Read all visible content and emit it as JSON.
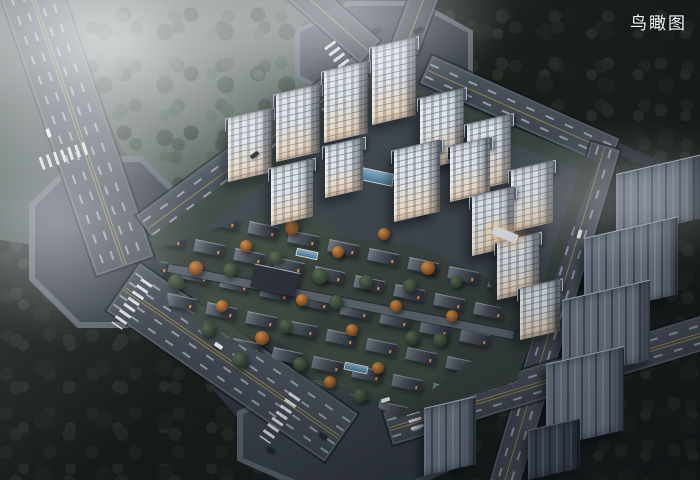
{
  "header": {
    "view_label": "鸟瞰图"
  },
  "palette": {
    "fog": "#e8ecee",
    "asphalt": "#454b55",
    "intersection": "#3a404a",
    "lane_white": "#dfe6ec",
    "lane_yellow": "#9b8c4d",
    "tower_facade": "#dde3e8",
    "tower_roof": "#39414f",
    "window_glow": "#f2a85c",
    "villa_roof": "#4a505a",
    "context_building_light": "#6f7988",
    "context_building_dark": "#434b58",
    "forest_dark": "#262e2a",
    "meadow": "#4a5350",
    "lawn": "#3e4c41",
    "pool_water": "#6e9ab5",
    "autumn_tree": "#c8853f",
    "green_tree": "#4c5c46"
  },
  "scene": {
    "towers": [
      {
        "x": 228,
        "y": 118,
        "w": 44,
        "h": 64
      },
      {
        "x": 276,
        "y": 94,
        "w": 44,
        "h": 68
      },
      {
        "x": 324,
        "y": 71,
        "w": 44,
        "h": 72
      },
      {
        "x": 372,
        "y": 47,
        "w": 44,
        "h": 78
      },
      {
        "x": 420,
        "y": 98,
        "w": 44,
        "h": 72
      },
      {
        "x": 467,
        "y": 124,
        "w": 44,
        "h": 68
      },
      {
        "x": 511,
        "y": 170,
        "w": 42,
        "h": 62
      },
      {
        "x": 271,
        "y": 168,
        "w": 42,
        "h": 58
      },
      {
        "x": 325,
        "y": 146,
        "w": 38,
        "h": 52
      },
      {
        "x": 394,
        "y": 150,
        "w": 46,
        "h": 72
      },
      {
        "x": 450,
        "y": 146,
        "w": 40,
        "h": 56
      },
      {
        "x": 472,
        "y": 196,
        "w": 42,
        "h": 60
      },
      {
        "x": 497,
        "y": 242,
        "w": 42,
        "h": 58
      },
      {
        "x": 520,
        "y": 288,
        "w": 40,
        "h": 52
      }
    ],
    "context_buildings": [
      {
        "x": 616,
        "y": 174,
        "w": 84,
        "h": 64,
        "tone": "light"
      },
      {
        "x": 584,
        "y": 238,
        "w": 94,
        "h": 78,
        "tone": "light"
      },
      {
        "x": 562,
        "y": 300,
        "w": 88,
        "h": 80,
        "tone": "light"
      },
      {
        "x": 546,
        "y": 364,
        "w": 78,
        "h": 84,
        "tone": "light"
      },
      {
        "x": 424,
        "y": 408,
        "w": 52,
        "h": 68,
        "tone": "light"
      },
      {
        "x": 528,
        "y": 430,
        "w": 52,
        "h": 50,
        "tone": "dark"
      }
    ],
    "villa_grid": {
      "rows": 7,
      "cols": 9,
      "origin_x": 168,
      "origin_y": 206,
      "col_dx": 40,
      "col_dy": 9,
      "row_dx": -14,
      "row_dy": 27,
      "unit_w": 30,
      "unit_h": 12
    },
    "trees": [
      {
        "x": 196,
        "y": 268,
        "r": 7,
        "t": "a"
      },
      {
        "x": 246,
        "y": 246,
        "r": 6,
        "t": "a"
      },
      {
        "x": 292,
        "y": 228,
        "r": 7,
        "t": "a"
      },
      {
        "x": 338,
        "y": 252,
        "r": 6,
        "t": "a"
      },
      {
        "x": 384,
        "y": 234,
        "r": 6,
        "t": "a"
      },
      {
        "x": 428,
        "y": 268,
        "r": 7,
        "t": "a"
      },
      {
        "x": 452,
        "y": 316,
        "r": 6,
        "t": "a"
      },
      {
        "x": 302,
        "y": 300,
        "r": 6,
        "t": "a"
      },
      {
        "x": 352,
        "y": 330,
        "r": 6,
        "t": "a"
      },
      {
        "x": 262,
        "y": 338,
        "r": 7,
        "t": "a"
      },
      {
        "x": 222,
        "y": 306,
        "r": 6,
        "t": "a"
      },
      {
        "x": 396,
        "y": 306,
        "r": 6,
        "t": "a"
      },
      {
        "x": 330,
        "y": 382,
        "r": 6,
        "t": "a"
      },
      {
        "x": 378,
        "y": 368,
        "r": 6,
        "t": "a"
      },
      {
        "x": 420,
        "y": 210,
        "r": 5,
        "t": "a"
      },
      {
        "x": 176,
        "y": 282,
        "r": 8,
        "t": "g"
      },
      {
        "x": 230,
        "y": 270,
        "r": 7,
        "t": "g"
      },
      {
        "x": 276,
        "y": 258,
        "r": 7,
        "t": "g"
      },
      {
        "x": 320,
        "y": 276,
        "r": 8,
        "t": "g"
      },
      {
        "x": 366,
        "y": 282,
        "r": 7,
        "t": "g"
      },
      {
        "x": 410,
        "y": 286,
        "r": 7,
        "t": "g"
      },
      {
        "x": 440,
        "y": 340,
        "r": 7,
        "t": "g"
      },
      {
        "x": 286,
        "y": 326,
        "r": 7,
        "t": "g"
      },
      {
        "x": 336,
        "y": 302,
        "r": 7,
        "t": "g"
      },
      {
        "x": 240,
        "y": 360,
        "r": 8,
        "t": "g"
      },
      {
        "x": 300,
        "y": 364,
        "r": 7,
        "t": "g"
      },
      {
        "x": 360,
        "y": 396,
        "r": 7,
        "t": "g"
      },
      {
        "x": 412,
        "y": 338,
        "r": 7,
        "t": "g"
      },
      {
        "x": 456,
        "y": 282,
        "r": 6,
        "t": "g"
      },
      {
        "x": 208,
        "y": 330,
        "r": 7,
        "t": "g"
      }
    ],
    "pools": [
      {
        "x": 356,
        "y": 170,
        "w": 38,
        "h": 13
      },
      {
        "x": 296,
        "y": 250,
        "w": 22,
        "h": 8
      },
      {
        "x": 344,
        "y": 364,
        "w": 24,
        "h": 8
      }
    ],
    "cars": [
      {
        "x": 44,
        "y": 131,
        "a": 71,
        "c": "#e9edf0"
      },
      {
        "x": 214,
        "y": 344,
        "a": 34,
        "c": "#e9edf0"
      },
      {
        "x": 319,
        "y": 434,
        "a": 34,
        "c": "#23282f"
      },
      {
        "x": 267,
        "y": 448,
        "a": 34,
        "c": "#23282f"
      },
      {
        "x": 381,
        "y": 398,
        "a": -17,
        "c": "#e9edf0"
      },
      {
        "x": 372,
        "y": 28,
        "a": -20,
        "c": "#23282f"
      },
      {
        "x": 414,
        "y": 28,
        "a": -20,
        "c": "#23282f"
      },
      {
        "x": 575,
        "y": 232,
        "a": 107,
        "c": "#e9edf0"
      },
      {
        "x": 250,
        "y": 153,
        "a": -36,
        "c": "#23282f"
      }
    ],
    "entrance": {
      "x": 492,
      "y": 230,
      "w": 26,
      "h": 9
    }
  }
}
